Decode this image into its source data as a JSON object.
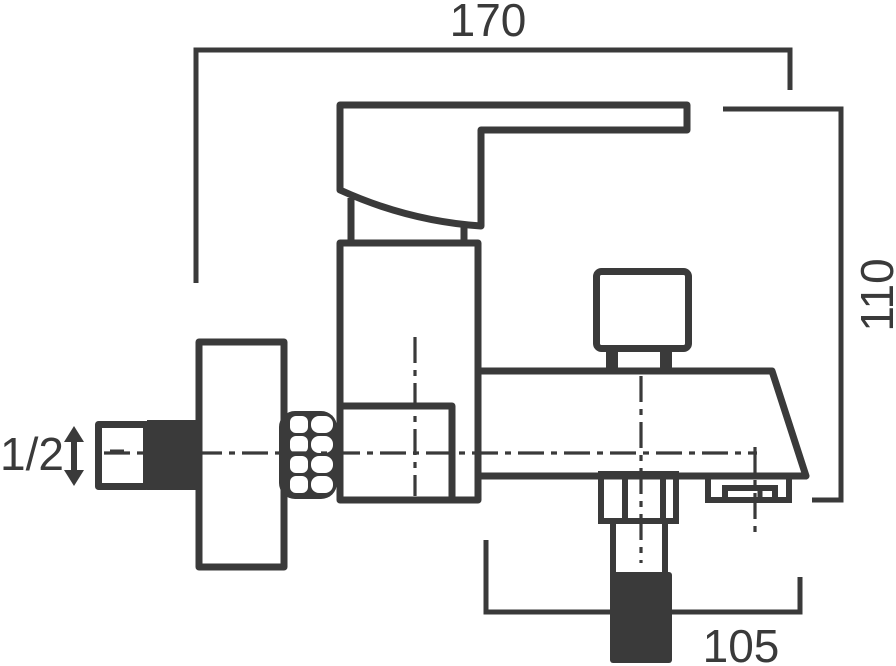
{
  "drawing": {
    "dimensions": {
      "overall_width": "170",
      "overall_height": "110",
      "spout_reach": "105",
      "inlet_connection": "1/2"
    }
  },
  "colors": {
    "ink": "#3a3a3a",
    "paper": "#ffffff"
  }
}
